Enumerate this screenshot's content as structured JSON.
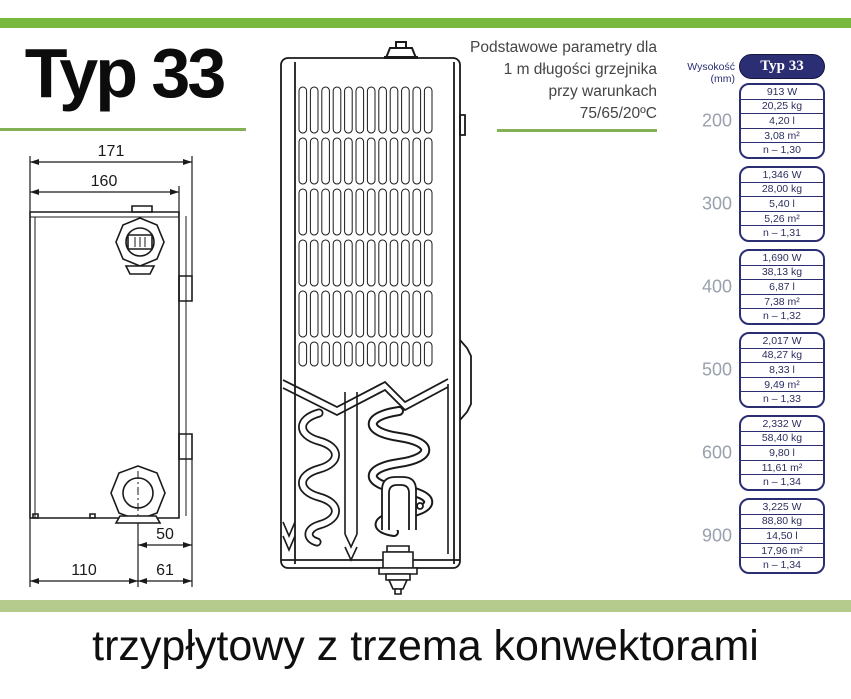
{
  "title": "Typ 33",
  "params_note": {
    "line1": "Podstawowe parametry dla",
    "line2": "1 m długości grzejnika",
    "line3": "przy warunkach",
    "line4": "75/65/20ºC"
  },
  "caption": "trzypłytowy z trzema konwektorami",
  "diagram": {
    "dim_171": "171",
    "dim_160": "160",
    "dim_50": "50",
    "dim_110": "110",
    "dim_61": "61"
  },
  "table": {
    "height_header": "Wysokość (mm)",
    "type_header": "Typ 33",
    "groups": [
      {
        "height": "200",
        "rows": [
          "913 W",
          "20,25 kg",
          "4,20 l",
          "3,08 m²",
          "n – 1,30"
        ]
      },
      {
        "height": "300",
        "rows": [
          "1,346 W",
          "28,00 kg",
          "5,40 l",
          "5,26 m²",
          "n – 1,31"
        ]
      },
      {
        "height": "400",
        "rows": [
          "1,690 W",
          "38,13 kg",
          "6,87 l",
          "7,38 m²",
          "n – 1,32"
        ]
      },
      {
        "height": "500",
        "rows": [
          "2,017 W",
          "48,27 kg",
          "8,33 l",
          "9,49 m²",
          "n – 1,33"
        ]
      },
      {
        "height": "600",
        "rows": [
          "2,332 W",
          "58,40 kg",
          "9,80 l",
          "11,61 m²",
          "n – 1,34"
        ]
      },
      {
        "height": "900",
        "rows": [
          "3,225 W",
          "88,80 kg",
          "14,50 l",
          "17,96 m²",
          "n – 1,34"
        ]
      }
    ]
  },
  "colors": {
    "accent_green": "#79b83e",
    "underline_green": "#84b156",
    "pale_green_band": "#b4cb8d",
    "navy": "#2b2e72",
    "height_gray": "#99a1ac"
  }
}
